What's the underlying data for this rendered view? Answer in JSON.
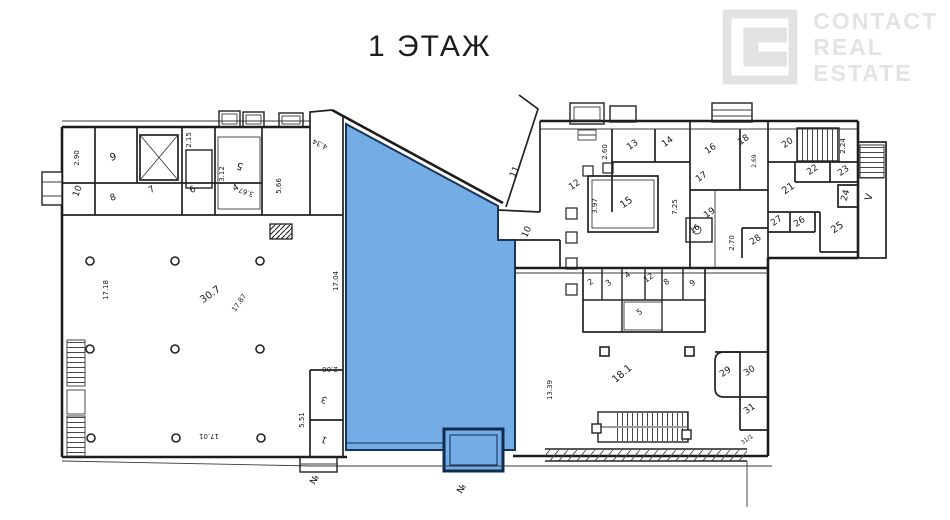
{
  "title": "1 ЭТАЖ",
  "logo": {
    "lines": [
      "CONTACT",
      "REAL",
      "ESTATE"
    ],
    "color": "#e3e3e3"
  },
  "colors": {
    "background": "#ffffff",
    "wall": "#1c1c1c",
    "label": "#1a1a1a",
    "highlight_fill": "#74ACE6",
    "highlight_stroke": "#16365C",
    "vestibule_stroke": "#0E2C50"
  },
  "highlight": {
    "name": "selected-premises-area",
    "polygon": "346,124 498,206 498,240 515,240 515,450 346,450",
    "vestibule": {
      "x": 444,
      "y": 429,
      "w": 59,
      "h": 42
    }
  },
  "labels": [
    {
      "t": "2.90",
      "x": 79,
      "y": 158,
      "r": -90,
      "s": 7
    },
    {
      "t": "9",
      "x": 114,
      "y": 160,
      "r": -15,
      "s": 10
    },
    {
      "t": "2.15",
      "x": 191,
      "y": 140,
      "r": -90,
      "s": 7
    },
    {
      "t": "3.12",
      "x": 224,
      "y": 174,
      "r": -90,
      "s": 7
    },
    {
      "t": "5",
      "x": 241,
      "y": 163,
      "r": -160,
      "s": 10
    },
    {
      "t": "3.67",
      "x": 247,
      "y": 190,
      "r": -160,
      "s": 7
    },
    {
      "t": "5.66",
      "x": 281,
      "y": 186,
      "r": -90,
      "s": 7
    },
    {
      "t": "10",
      "x": 80,
      "y": 192,
      "r": -70,
      "s": 9
    },
    {
      "t": "8",
      "x": 114,
      "y": 200,
      "r": -20,
      "s": 9
    },
    {
      "t": "7",
      "x": 153,
      "y": 192,
      "r": -30,
      "s": 9
    },
    {
      "t": "6",
      "x": 194,
      "y": 192,
      "r": -30,
      "s": 9
    },
    {
      "t": "4",
      "x": 237,
      "y": 190,
      "r": -30,
      "s": 9
    },
    {
      "t": "4.34",
      "x": 321,
      "y": 142,
      "r": -155,
      "s": 7
    },
    {
      "t": "17.04",
      "x": 338,
      "y": 281,
      "r": -90,
      "s": 7
    },
    {
      "t": "17.18",
      "x": 108,
      "y": 290,
      "r": -90,
      "s": 7
    },
    {
      "t": "30.7",
      "x": 212,
      "y": 297,
      "r": -35,
      "s": 10
    },
    {
      "t": "17.87",
      "x": 241,
      "y": 304,
      "r": -55,
      "s": 7
    },
    {
      "t": "17.01",
      "x": 209,
      "y": 434,
      "r": 180,
      "s": 7
    },
    {
      "t": "2.06",
      "x": 330,
      "y": 367,
      "r": 180,
      "s": 7
    },
    {
      "t": "3",
      "x": 325,
      "y": 397,
      "r": -160,
      "s": 9
    },
    {
      "t": "5.51",
      "x": 304,
      "y": 420,
      "r": -90,
      "s": 7
    },
    {
      "t": "1",
      "x": 325,
      "y": 437,
      "r": -160,
      "s": 9
    },
    {
      "t": "№",
      "x": 317,
      "y": 481,
      "r": -60,
      "s": 9
    },
    {
      "t": "№",
      "x": 464,
      "y": 490,
      "r": -60,
      "s": 9
    },
    {
      "t": "11",
      "x": 517,
      "y": 173,
      "r": -65,
      "s": 9
    },
    {
      "t": "10",
      "x": 529,
      "y": 233,
      "r": -65,
      "s": 9
    },
    {
      "t": "2.60",
      "x": 607,
      "y": 152,
      "r": -90,
      "s": 7
    },
    {
      "t": "13",
      "x": 634,
      "y": 147,
      "r": -35,
      "s": 9
    },
    {
      "t": "14",
      "x": 669,
      "y": 144,
      "r": -35,
      "s": 9
    },
    {
      "t": "16",
      "x": 712,
      "y": 151,
      "r": -35,
      "s": 9
    },
    {
      "t": "18",
      "x": 745,
      "y": 142,
      "r": -35,
      "s": 9
    },
    {
      "t": "2.69",
      "x": 756,
      "y": 161,
      "r": -90,
      "s": 6
    },
    {
      "t": "20",
      "x": 789,
      "y": 145,
      "r": -35,
      "s": 9
    },
    {
      "t": "2.24",
      "x": 845,
      "y": 146,
      "r": -90,
      "s": 7
    },
    {
      "t": "22",
      "x": 814,
      "y": 172,
      "r": -35,
      "s": 9
    },
    {
      "t": "23",
      "x": 845,
      "y": 173,
      "r": -35,
      "s": 9
    },
    {
      "t": "21",
      "x": 790,
      "y": 191,
      "r": -35,
      "s": 10
    },
    {
      "t": "24",
      "x": 848,
      "y": 196,
      "r": -75,
      "s": 9
    },
    {
      "t": "V",
      "x": 872,
      "y": 198,
      "r": -75,
      "s": 10
    },
    {
      "t": "12",
      "x": 576,
      "y": 187,
      "r": -35,
      "s": 9
    },
    {
      "t": "15",
      "x": 628,
      "y": 205,
      "r": -35,
      "s": 10
    },
    {
      "t": "3.97",
      "x": 597,
      "y": 206,
      "r": -90,
      "s": 7
    },
    {
      "t": "7.25",
      "x": 677,
      "y": 207,
      "r": -90,
      "s": 7
    },
    {
      "t": "17",
      "x": 703,
      "y": 179,
      "r": -35,
      "s": 9
    },
    {
      "t": "19",
      "x": 711,
      "y": 215,
      "r": -35,
      "s": 9
    },
    {
      "t": "16",
      "x": 696,
      "y": 231,
      "r": -35,
      "s": 8
    },
    {
      "t": "27",
      "x": 778,
      "y": 223,
      "r": -35,
      "s": 9
    },
    {
      "t": "26",
      "x": 801,
      "y": 224,
      "r": -35,
      "s": 9
    },
    {
      "t": "25",
      "x": 839,
      "y": 230,
      "r": -35,
      "s": 10
    },
    {
      "t": "28",
      "x": 757,
      "y": 242,
      "r": -35,
      "s": 9
    },
    {
      "t": "2.70",
      "x": 734,
      "y": 243,
      "r": -90,
      "s": 7
    },
    {
      "t": "2",
      "x": 592,
      "y": 284,
      "r": -35,
      "s": 8
    },
    {
      "t": "3",
      "x": 610,
      "y": 285,
      "r": -35,
      "s": 8
    },
    {
      "t": "4",
      "x": 629,
      "y": 277,
      "r": -35,
      "s": 8
    },
    {
      "t": "12",
      "x": 650,
      "y": 280,
      "r": -35,
      "s": 8
    },
    {
      "t": "8",
      "x": 668,
      "y": 284,
      "r": -35,
      "s": 8
    },
    {
      "t": "9",
      "x": 694,
      "y": 285,
      "r": -35,
      "s": 8
    },
    {
      "t": "5",
      "x": 641,
      "y": 314,
      "r": -35,
      "s": 8
    },
    {
      "t": "13.39",
      "x": 552,
      "y": 390,
      "r": -90,
      "s": 7
    },
    {
      "t": "18.1",
      "x": 624,
      "y": 376,
      "r": -40,
      "s": 10
    },
    {
      "t": "29",
      "x": 727,
      "y": 374,
      "r": -35,
      "s": 9
    },
    {
      "t": "30",
      "x": 751,
      "y": 373,
      "r": -35,
      "s": 9
    },
    {
      "t": "31",
      "x": 751,
      "y": 411,
      "r": -35,
      "s": 9
    },
    {
      "t": "31/1",
      "x": 748,
      "y": 441,
      "r": -35,
      "s": 6
    }
  ]
}
